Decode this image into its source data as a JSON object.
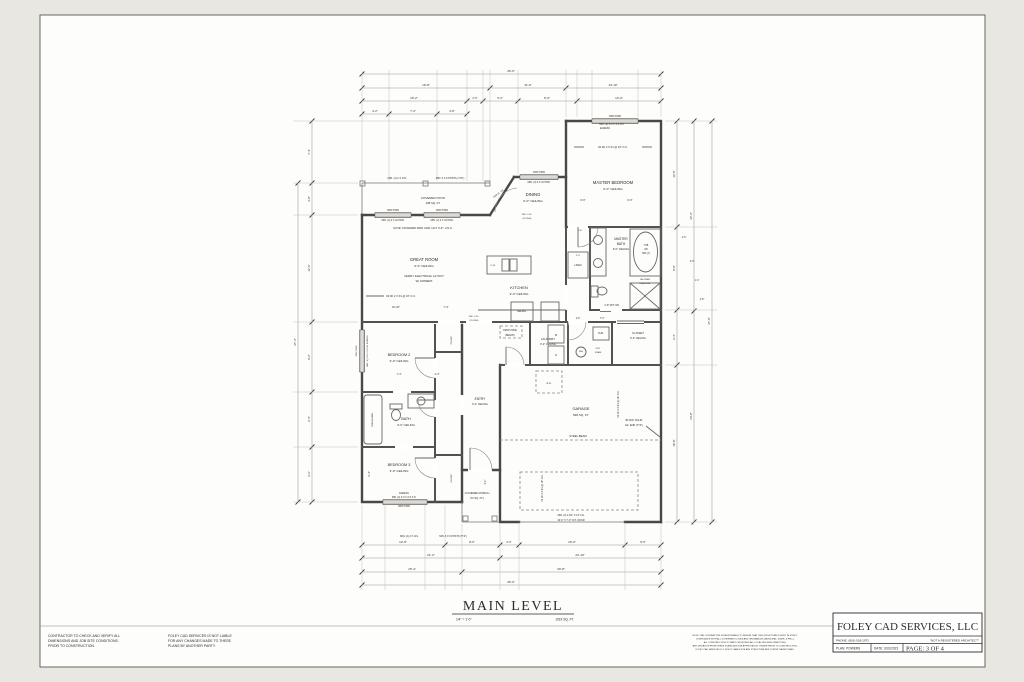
{
  "page": {
    "title": "MAIN LEVEL",
    "scale": "1/4\" = 1'-0\"",
    "area": "1919 SQ. FT.",
    "disclaimer1": [
      "CONTRACTOR TO CHECK AND VERIFY ALL",
      "DIMENSIONS AND JOB SITE CONDITIONS",
      "PRIOR TO CONSTRUCTION."
    ],
    "disclaimer2": [
      "FOLEY CAD SERVICES IS NOT LIABLE",
      "FOR ANY CHANGES MADE TO THESE",
      "PLANS BY ANOTHER PARTY."
    ],
    "fine_print": [
      "NOTE: THE CONTRACTOR IS RESPONSIBLE TO INSURE THAT THIS STRUCTURE IS BUILT IN STRICT",
      "COMPLIANCE WITH ALL GOVERNING CODES AND ORDINANCES (MUNICIPAL, STATE, & FED.),",
      "ALL CONSTRUCTION TO MEET OR EXCEED ALL LOCAL BUILDING PRACTICES,",
      "ANY DEVIATION FROM THESE PLANS MUST BE APPROVED BY OWNER PRIOR TO CONSTRUCTION,",
      "FOLEY CAD SERVICES LLC IS NOT LIABLE FOR ANY STRUCTURE BUILT FROM THESE PLANS."
    ]
  },
  "title_block": {
    "company": "FOLEY CAD SERVICES, LLC",
    "phone": "PHONE: (816) 518-2973",
    "registered": "\"NOT A REGISTERED ARCHITECT\"",
    "plan": "PLAN:  POWERS",
    "date": "DATE:  3/31/2023",
    "page": "PAGE: 3 OF 4"
  },
  "plan": {
    "labels": [
      {
        "t": "MASTER BEDROOM",
        "x": 613,
        "y": 184,
        "s": 4.2
      },
      {
        "t": "9'-0\" CEILING",
        "x": 613,
        "y": 190,
        "s": 3.1
      },
      {
        "t": "DINING",
        "x": 533,
        "y": 196,
        "s": 4.2
      },
      {
        "t": "9'-0\" CEILING",
        "x": 533,
        "y": 202,
        "s": 3.1
      },
      {
        "t": "GREAT ROOM",
        "x": 424,
        "y": 261,
        "s": 4.2
      },
      {
        "t": "9'-0\" CEILING",
        "x": 424,
        "y": 267,
        "s": 3.1
      },
      {
        "t": "VERIFY ELECTRICAL LAYOUT",
        "x": 424,
        "y": 277,
        "s": 2.8
      },
      {
        "t": "W/ OWNERS",
        "x": 424,
        "y": 282,
        "s": 2.8
      },
      {
        "t": "KITCHEN",
        "x": 519,
        "y": 289,
        "s": 4.0
      },
      {
        "t": "9'-0\" CEILING",
        "x": 519,
        "y": 295,
        "s": 3.0
      },
      {
        "t": "MASTER",
        "x": 621,
        "y": 240,
        "s": 3.2
      },
      {
        "t": "BATH",
        "x": 621,
        "y": 245,
        "s": 3.2
      },
      {
        "t": "9'-0\" CEILING",
        "x": 621,
        "y": 250,
        "s": 2.6
      },
      {
        "t": "LAUNDRY",
        "x": 548,
        "y": 340,
        "s": 3.0
      },
      {
        "t": "9'-0\" CEILING",
        "x": 548,
        "y": 345,
        "s": 2.5
      },
      {
        "t": "CLOSET",
        "x": 638,
        "y": 334,
        "s": 3.0
      },
      {
        "t": "9'-0\" CEILING",
        "x": 638,
        "y": 339,
        "s": 2.5
      },
      {
        "t": "GARAGE",
        "x": 581,
        "y": 410,
        "s": 4.0
      },
      {
        "t": "598 SQ. FT.",
        "x": 581,
        "y": 416,
        "s": 3.0
      },
      {
        "t": "ENTRY",
        "x": 480,
        "y": 400,
        "s": 3.2
      },
      {
        "t": "9'-0\" CEILING",
        "x": 480,
        "y": 405,
        "s": 2.5
      },
      {
        "t": "BEDROOM 2",
        "x": 399,
        "y": 356,
        "s": 3.8
      },
      {
        "t": "9'-0\" CEILING",
        "x": 399,
        "y": 362,
        "s": 3.0
      },
      {
        "t": "BATH",
        "x": 406,
        "y": 420,
        "s": 3.6
      },
      {
        "t": "9'-0\" CEILING",
        "x": 406,
        "y": 426,
        "s": 2.8
      },
      {
        "t": "BEDROOM 3",
        "x": 399,
        "y": 466,
        "s": 3.8
      },
      {
        "t": "9'-0\" CEILING",
        "x": 399,
        "y": 472,
        "s": 3.0
      },
      {
        "t": "COVERED PATIO",
        "x": 433,
        "y": 199,
        "s": 3.0
      },
      {
        "t": "198 SQ. FT.",
        "x": 433,
        "y": 204,
        "s": 2.8
      },
      {
        "t": "COVERED PORCH",
        "x": 477,
        "y": 494,
        "s": 2.8
      },
      {
        "t": "(72 SQ. FT.)",
        "x": 477,
        "y": 499,
        "s": 2.6
      },
      {
        "t": "MIN. (2) 2 X 10's",
        "x": 397,
        "y": 179,
        "s": 2.5
      },
      {
        "t": "MIN. 6 X 6 POSTS (TYP.)",
        "x": 450,
        "y": 179,
        "s": 2.5
      },
      {
        "t": "3050 TWIN",
        "x": 393,
        "y": 211,
        "s": 2.4
      },
      {
        "t": "3050 TWIN",
        "x": 442,
        "y": 211,
        "s": 2.4
      },
      {
        "t": "MIN. (2) 2 X 10 HDR.",
        "x": 393,
        "y": 221,
        "s": 2.4
      },
      {
        "t": "MIN. (2) 2 X 10 HDR.",
        "x": 442,
        "y": 221,
        "s": 2.4
      },
      {
        "t": "NOTE: STANDARD WND. HDR. HGT. 6'-8\", U.N.O.",
        "x": 423,
        "y": 229,
        "s": 2.6
      },
      {
        "t": "3050 TWIN",
        "x": 539,
        "y": 173,
        "s": 2.4
      },
      {
        "t": "MIN. (2) 2 X 10 HDR.",
        "x": 539,
        "y": 183,
        "s": 2.4
      },
      {
        "t": "3050 TWIN",
        "x": 615,
        "y": 117,
        "s": 2.4
      },
      {
        "t": "MIN. (2) 3'-0 X 4'-0 S.H.",
        "x": 612,
        "y": 125,
        "s": 2.4
      },
      {
        "t": "EGRESS",
        "x": 605,
        "y": 129,
        "s": 2.4
      },
      {
        "t": "#2 DF 2 X 6's @ 16\" O.C.",
        "x": 613,
        "y": 148,
        "s": 2.6
      },
      {
        "t": "#2 DF 2 X 6's @ 16\" O.C.",
        "x": 401,
        "y": 297,
        "s": 2.6
      },
      {
        "t": "DBL. 2-FL.",
        "x": 527,
        "y": 215,
        "s": 2.2
      },
      {
        "t": "(FLUSH)",
        "x": 527,
        "y": 219,
        "s": 2.2
      },
      {
        "t": "DBL. 2-FL.",
        "x": 474,
        "y": 317,
        "s": 2.2
      },
      {
        "t": "(FLUSH)",
        "x": 474,
        "y": 321,
        "s": 2.2
      },
      {
        "t": "STEEL BEAM",
        "x": 578,
        "y": 437,
        "s": 2.8
      },
      {
        "t": "BLOCK SOLID",
        "x": 634,
        "y": 421,
        "s": 2.5
      },
      {
        "t": "EA. END (TYP.)",
        "x": 634,
        "y": 426,
        "s": 2.5
      },
      {
        "t": "A.A.",
        "x": 549,
        "y": 384,
        "s": 2.6
      },
      {
        "t": "MIN. (2) 1-3/4\" X 14\" LVL",
        "x": 571,
        "y": 516,
        "s": 2.4
      },
      {
        "t": "16'-0\" X 7'-0\" O.H. DOOR",
        "x": 571,
        "y": 521,
        "s": 2.4
      },
      {
        "t": "EGRESS",
        "x": 404,
        "y": 494,
        "s": 2.3
      },
      {
        "t": "MIN. (2) 3'-0 X 4'-0 S.H.",
        "x": 404,
        "y": 498,
        "s": 2.3
      },
      {
        "t": "3050 TWIN",
        "x": 404,
        "y": 507,
        "s": 2.4
      },
      {
        "t": "MIN. (2) 2 X 10's",
        "x": 409,
        "y": 537,
        "s": 2.4
      },
      {
        "t": "MIN. 6 X 6 POSTS (TYP.)",
        "x": 453,
        "y": 537,
        "s": 2.4
      },
      {
        "t": "3050 TWIN",
        "x": 357,
        "y": 351,
        "s": 2.2,
        "r": -90
      },
      {
        "t": "MIN. (2) 3'-0 X 4'-0 S.H. EGRESS",
        "x": 368,
        "y": 351,
        "s": 2.1,
        "r": -90
      },
      {
        "t": "#2 DF 2 X 6's @ 16\" O.C.",
        "x": 619,
        "y": 404,
        "s": 2.4,
        "r": -90
      },
      {
        "t": "#2 DF 2 X 6's @ 16\" O.C.",
        "x": 543,
        "y": 488,
        "s": 2.4,
        "r": -90
      },
      {
        "t": "2'-8\" PKT. DR.",
        "x": 612,
        "y": 306,
        "s": 2.4
      },
      {
        "t": "LINEN",
        "x": 578,
        "y": 266,
        "s": 2.4
      },
      {
        "t": "2'-0\"",
        "x": 578,
        "y": 256,
        "s": 2.2
      },
      {
        "t": "DROP ZONE",
        "x": 510,
        "y": 331,
        "s": 2.3
      },
      {
        "t": "(BENCH)",
        "x": 510,
        "y": 336,
        "s": 2.3
      },
      {
        "t": "FUR.",
        "x": 601,
        "y": 334,
        "s": 2.4
      },
      {
        "t": "W/H",
        "x": 581,
        "y": 352,
        "s": 2.2
      },
      {
        "t": "FLR.",
        "x": 598,
        "y": 349,
        "s": 2.1
      },
      {
        "t": "DRAIN",
        "x": 598,
        "y": 353,
        "s": 2.1
      },
      {
        "t": "REFRIG.",
        "x": 522,
        "y": 312,
        "s": 2.3
      },
      {
        "t": "D.W.",
        "x": 493,
        "y": 266,
        "s": 2.2
      },
      {
        "t": "TUB",
        "x": 646,
        "y": 246,
        "s": 2.3
      },
      {
        "t": "OR",
        "x": 646,
        "y": 250,
        "s": 2.3
      },
      {
        "t": "SPA (?)",
        "x": 646,
        "y": 254,
        "s": 2.3
      },
      {
        "t": "SHOWER",
        "x": 645,
        "y": 280,
        "s": 2.2
      },
      {
        "t": "GLASS DR.",
        "x": 645,
        "y": 284,
        "s": 2.2
      },
      {
        "t": "4068 SL. DR.",
        "x": 499,
        "y": 194,
        "s": 2.2,
        "r": -37
      },
      {
        "t": "TUB/SHOWER",
        "x": 373,
        "y": 420,
        "s": 2.1,
        "r": -90
      },
      {
        "t": "CLOSET",
        "x": 452,
        "y": 340,
        "s": 2.2,
        "r": -90
      },
      {
        "t": "CLOSET",
        "x": 452,
        "y": 478,
        "s": 2.2,
        "r": -90
      },
      {
        "t": "W",
        "x": 556,
        "y": 336,
        "s": 2.4
      },
      {
        "t": "D",
        "x": 556,
        "y": 356,
        "s": 2.4
      },
      {
        "t": "46'-0\"",
        "x": 511,
        "y": 72,
        "s": 3.0
      },
      {
        "t": "19'-8\"",
        "x": 426,
        "y": 86,
        "s": 3.0
      },
      {
        "t": "11'-6\"",
        "x": 528,
        "y": 86,
        "s": 3.0
      },
      {
        "t": "14'-10\"",
        "x": 613,
        "y": 86,
        "s": 3.0
      },
      {
        "t": "16'-2\"",
        "x": 414,
        "y": 99,
        "s": 3.0
      },
      {
        "t": "2'-6\"",
        "x": 475,
        "y": 99,
        "s": 2.6
      },
      {
        "t": "5'-4\"",
        "x": 500,
        "y": 99,
        "s": 2.8
      },
      {
        "t": "9'-0\"",
        "x": 547,
        "y": 99,
        "s": 3.0
      },
      {
        "t": "13'-0\"",
        "x": 619,
        "y": 99,
        "s": 3.0
      },
      {
        "t": "4'-2\"",
        "x": 375,
        "y": 112,
        "s": 2.8
      },
      {
        "t": "7'-4\"",
        "x": 413,
        "y": 112,
        "s": 2.8
      },
      {
        "t": "4'-8\"",
        "x": 452,
        "y": 112,
        "s": 2.8
      },
      {
        "t": "12'-8\"",
        "x": 403,
        "y": 543,
        "s": 3.0
      },
      {
        "t": "8'-6\"",
        "x": 472,
        "y": 543,
        "s": 2.8
      },
      {
        "t": "3'-0\"",
        "x": 509,
        "y": 543,
        "s": 2.6
      },
      {
        "t": "16'-0\"",
        "x": 572,
        "y": 543,
        "s": 3.0
      },
      {
        "t": "5'-6\"",
        "x": 643,
        "y": 543,
        "s": 2.8
      },
      {
        "t": "21'-2\"",
        "x": 431,
        "y": 556,
        "s": 3.0
      },
      {
        "t": "24'-10\"",
        "x": 580,
        "y": 556,
        "s": 3.0
      },
      {
        "t": "15'-4\"",
        "x": 412,
        "y": 570,
        "s": 3.0
      },
      {
        "t": "30'-8\"",
        "x": 561,
        "y": 570,
        "s": 3.0
      },
      {
        "t": "46'-0\"",
        "x": 511,
        "y": 583,
        "s": 3.0
      },
      {
        "t": "7'-4\"",
        "x": 310,
        "y": 152,
        "s": 2.8,
        "r": -90
      },
      {
        "t": "3'-8\"",
        "x": 310,
        "y": 199,
        "s": 2.8,
        "r": -90
      },
      {
        "t": "12'-6\"",
        "x": 310,
        "y": 268,
        "s": 2.8,
        "r": -90
      },
      {
        "t": "9'-2\"",
        "x": 310,
        "y": 357,
        "s": 2.8,
        "r": -90
      },
      {
        "t": "6'-4\"",
        "x": 310,
        "y": 419,
        "s": 2.8,
        "r": -90
      },
      {
        "t": "6'-6\"",
        "x": 310,
        "y": 474,
        "s": 2.8,
        "r": -90
      },
      {
        "t": "37'-4\"",
        "x": 296,
        "y": 342,
        "s": 3.0,
        "r": -90
      },
      {
        "t": "12'-8\"",
        "x": 675,
        "y": 174,
        "s": 2.8,
        "r": -90
      },
      {
        "t": "9'-8\"",
        "x": 675,
        "y": 268,
        "s": 2.8,
        "r": -90
      },
      {
        "t": "6'-4\"",
        "x": 675,
        "y": 337,
        "s": 2.8,
        "r": -90
      },
      {
        "t": "18'-8\"",
        "x": 675,
        "y": 443,
        "s": 2.8,
        "r": -90
      },
      {
        "t": "22'-4\"",
        "x": 692,
        "y": 216,
        "s": 2.8,
        "r": -90
      },
      {
        "t": "24'-8\"",
        "x": 692,
        "y": 416,
        "s": 2.8,
        "r": -90
      },
      {
        "t": "47'-0\"",
        "x": 710,
        "y": 321,
        "s": 3.0,
        "r": -90
      },
      {
        "t": "19'-10\"",
        "x": 396,
        "y": 308,
        "s": 2.6
      },
      {
        "t": "7'-4\"",
        "x": 446,
        "y": 308,
        "s": 2.6
      },
      {
        "t": "9'-0\"",
        "x": 583,
        "y": 201,
        "s": 2.6
      },
      {
        "t": "9'-0\"",
        "x": 630,
        "y": 201,
        "s": 2.6
      },
      {
        "t": "7'-4\"",
        "x": 399,
        "y": 375,
        "s": 2.5
      },
      {
        "t": "4'-4\"",
        "x": 437,
        "y": 375,
        "s": 2.5
      },
      {
        "t": "2'-6\"",
        "x": 578,
        "y": 319,
        "s": 2.3
      },
      {
        "t": "7'-0\"",
        "x": 602,
        "y": 319,
        "s": 2.3
      },
      {
        "t": "6'-2\"",
        "x": 486,
        "y": 482,
        "s": 2.3,
        "r": -90
      },
      {
        "t": "11'-6\"",
        "x": 370,
        "y": 474,
        "s": 2.3,
        "r": -90
      },
      {
        "t": "2'-8\"",
        "x": 580,
        "y": 231,
        "s": 2.2
      },
      {
        "t": "2'-6\"",
        "x": 684,
        "y": 238,
        "s": 2.3
      },
      {
        "t": "3'-0\"",
        "x": 692,
        "y": 262,
        "s": 2.3
      },
      {
        "t": "1'-4\"",
        "x": 697,
        "y": 281,
        "s": 2.3
      },
      {
        "t": "4'-8\"",
        "x": 702,
        "y": 300,
        "s": 2.3
      }
    ]
  }
}
